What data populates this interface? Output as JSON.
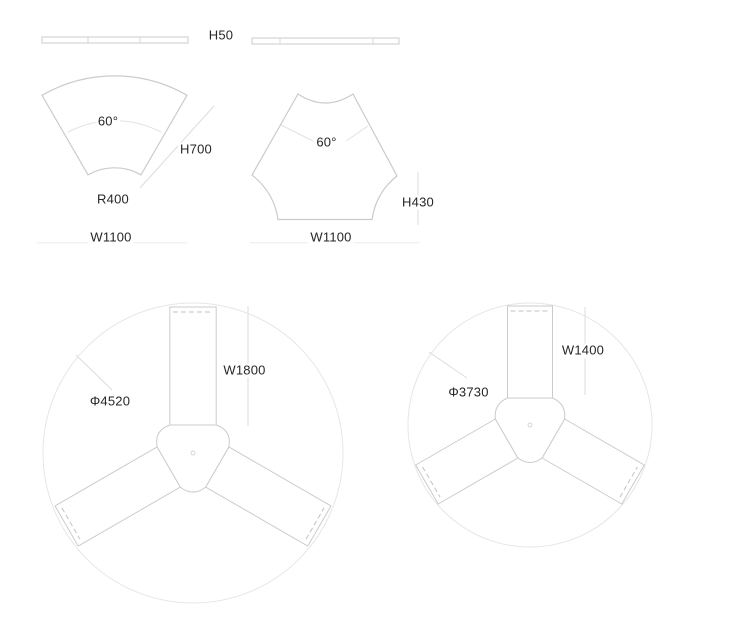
{
  "diagram": {
    "title_hint": "modular desk technical drawing",
    "side_panel": {
      "height_label": "H50"
    },
    "fan_desk": {
      "angle_label": "60°",
      "side_height_label": "H700",
      "inner_radius_label": "R400",
      "width_label": "W1100"
    },
    "hex_desk": {
      "angle_label": "60°",
      "height_label": "H430",
      "width_label": "W1100"
    },
    "cluster_large": {
      "diameter_label": "Φ4520",
      "desk_length_label": "W1800",
      "desk_count": 3
    },
    "cluster_small": {
      "diameter_label": "Φ3730",
      "desk_length_label": "W1400",
      "desk_count": 3
    }
  },
  "colors": {
    "background": "#ffffff",
    "shape_stroke": "#c9cccd",
    "light_circle_stroke": "#e6e6e6",
    "dimension_stroke": "#dcdcdc",
    "dashed_stroke": "#c2c2c2",
    "text": "#262626"
  }
}
